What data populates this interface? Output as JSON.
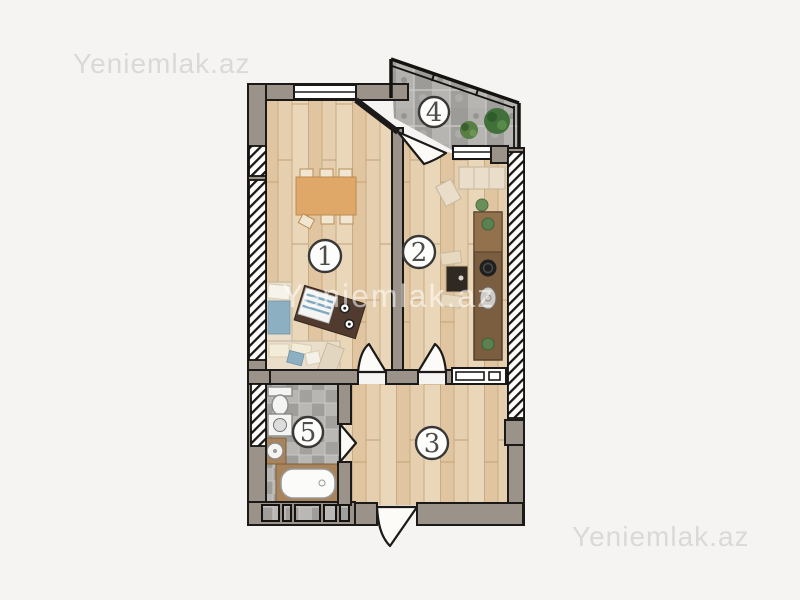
{
  "watermarks": {
    "top_left": "Yeniemlak.az",
    "center": "Yeniemlak.az",
    "bottom_right": "Yeniemlak.az"
  },
  "floor_plan": {
    "rooms": [
      {
        "number": "1"
      },
      {
        "number": "2"
      },
      {
        "number": "3"
      },
      {
        "number": "4"
      },
      {
        "number": "5"
      }
    ],
    "palette": {
      "background": "#f5f4f2",
      "wall": "#9b9289",
      "wall_outline": "#1c1a18",
      "wood_floor": "#e5cfae",
      "stone_tile": "#a8a6a3",
      "dining_table": "#dfa768",
      "coffee_table": "#503b2e",
      "kitchen_counter": "#7b5d3f",
      "sofa_beige": "#eaddca",
      "pillow_blue": "#8cb0c2",
      "plant_green": "#41703a",
      "watermark_gray": "#d9d9d9"
    }
  }
}
